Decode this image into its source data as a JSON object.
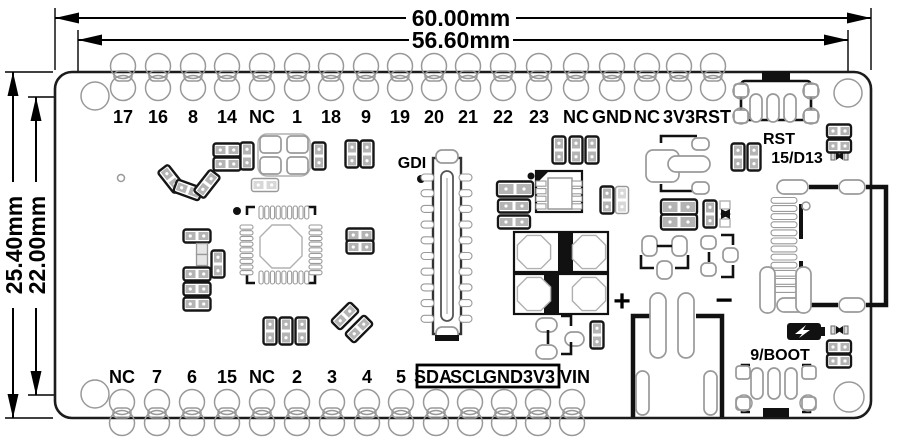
{
  "drawing": {
    "type": "pcb-dimension-drawing",
    "colors": {
      "line": "#000000",
      "pad_stroke": "#999999",
      "board_fill": "#ffffff"
    },
    "dimensions": {
      "width_outer": "60.00mm",
      "width_inner": "56.60mm",
      "height_outer": "25.40mm",
      "height_inner": "22.00mm"
    },
    "labels": {
      "gdi": "GDI",
      "rst_button": "RST",
      "io15": "15/D13",
      "boot_button": "9/BOOT",
      "battery_plus": "+",
      "battery_minus": "−",
      "vin": "VIN"
    },
    "icons": [
      "charge-icon",
      "led-icon",
      "gdi-pin1-dot",
      "ic-pin1-dot"
    ],
    "pins": {
      "top": {
        "labels": [
          "17",
          "16",
          "8",
          "14",
          "NC",
          "1",
          "18",
          "9",
          "19",
          "20",
          "21",
          "22",
          "23",
          "NC",
          "GND",
          "NC",
          "3V3",
          "RST"
        ],
        "xs": [
          123,
          158,
          193,
          227,
          262,
          297,
          331,
          366,
          400,
          434,
          468,
          503,
          539,
          576,
          612,
          647,
          679,
          713
        ]
      },
      "bottom": {
        "labels": [
          "NC",
          "7",
          "6",
          "15",
          "NC",
          "2",
          "3",
          "4",
          "5"
        ],
        "xs": [
          122,
          157,
          192,
          227,
          262,
          297,
          332,
          367,
          401,
          436,
          470,
          504,
          538,
          572
        ]
      },
      "boxed": {
        "labels": [
          "SDA",
          "SCL",
          "GND",
          "3V3"
        ],
        "xs": [
          433,
          468,
          503,
          539
        ]
      }
    },
    "components": [
      {
        "t": "p2h",
        "x": 227,
        "y": 150
      },
      {
        "t": "p2h",
        "x": 227,
        "y": 164
      },
      {
        "t": "p2v",
        "x": 247,
        "y": 156
      },
      {
        "t": "p2v",
        "x": 319,
        "y": 156
      },
      {
        "t": "p2v",
        "x": 352,
        "y": 154
      },
      {
        "t": "p2v",
        "x": 367,
        "y": 154
      },
      {
        "t": "p2v",
        "x": 171,
        "y": 179,
        "r": -38
      },
      {
        "t": "p2v",
        "x": 188,
        "y": 190,
        "r": -70
      },
      {
        "t": "p2v",
        "x": 207,
        "y": 184,
        "r": 38
      },
      {
        "t": "p2h",
        "x": 197,
        "y": 236
      },
      {
        "t": "lsq",
        "x": 202,
        "y": 249
      },
      {
        "t": "lsq",
        "x": 202,
        "y": 260
      },
      {
        "t": "p2v",
        "x": 218,
        "y": 264
      },
      {
        "t": "p2h",
        "x": 197,
        "y": 274
      },
      {
        "t": "p2h",
        "x": 197,
        "y": 289
      },
      {
        "t": "p2h",
        "x": 197,
        "y": 304
      },
      {
        "t": "p2v",
        "x": 270,
        "y": 331
      },
      {
        "t": "p2v",
        "x": 286,
        "y": 331
      },
      {
        "t": "p2v",
        "x": 302,
        "y": 331
      },
      {
        "t": "p2v",
        "x": 345,
        "y": 316,
        "r": 45
      },
      {
        "t": "p2v",
        "x": 359,
        "y": 329,
        "r": 45
      },
      {
        "t": "p2h",
        "x": 360,
        "y": 235
      },
      {
        "t": "p2h",
        "x": 360,
        "y": 247
      },
      {
        "t": "lp2h",
        "x": 265,
        "y": 185
      },
      {
        "t": "p2h",
        "x": 515,
        "y": 189,
        "w": 36,
        "h": 15
      },
      {
        "t": "p2h",
        "x": 514,
        "y": 206,
        "w": 32
      },
      {
        "t": "p2h",
        "x": 514,
        "y": 222,
        "w": 32
      },
      {
        "t": "p2v",
        "x": 559,
        "y": 150
      },
      {
        "t": "p2v",
        "x": 576,
        "y": 150
      },
      {
        "t": "p2v",
        "x": 592,
        "y": 150
      },
      {
        "t": "p2v",
        "x": 607,
        "y": 200
      },
      {
        "t": "lp2v",
        "x": 622,
        "y": 200
      },
      {
        "t": "p2h",
        "x": 679,
        "y": 207,
        "w": 36,
        "h": 15
      },
      {
        "t": "p2h",
        "x": 679,
        "y": 222,
        "w": 36,
        "h": 15
      },
      {
        "t": "p2v",
        "x": 710,
        "y": 214
      },
      {
        "t": "p2v",
        "x": 738,
        "y": 157
      },
      {
        "t": "p2v",
        "x": 754,
        "y": 157
      },
      {
        "t": "p2h",
        "x": 839,
        "y": 131,
        "w": 24
      },
      {
        "t": "p2h",
        "x": 839,
        "y": 146,
        "w": 24
      },
      {
        "t": "p2h",
        "x": 839,
        "y": 347,
        "w": 24
      },
      {
        "t": "p2h",
        "x": 839,
        "y": 361,
        "w": 24
      },
      {
        "t": "p2v",
        "x": 597,
        "y": 335
      },
      {
        "t": "via",
        "x": 121,
        "y": 178
      }
    ]
  }
}
